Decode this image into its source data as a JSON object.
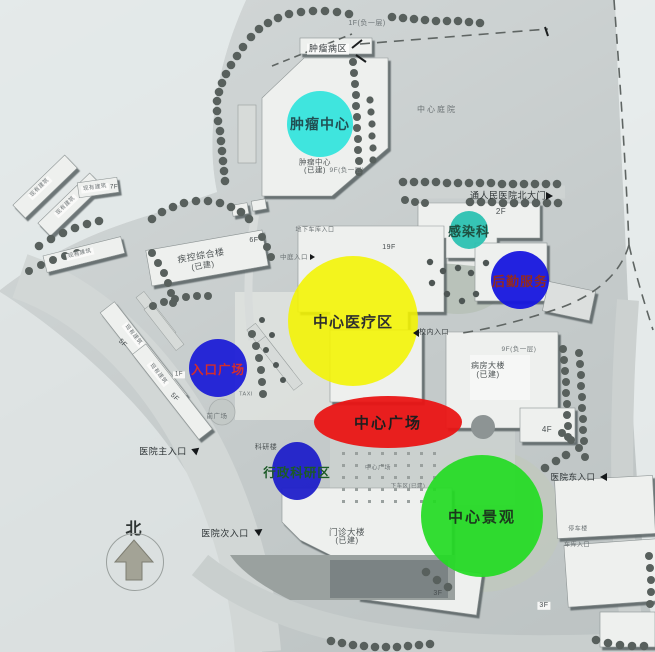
{
  "zones": [
    {
      "id": "tumor-center",
      "label": "肿瘤中心",
      "color": "#2ce4dc",
      "text_color": "#0b3d42"
    },
    {
      "id": "infection-dept",
      "label": "感染科",
      "color": "#26c0b0",
      "text_color": "#0d4433"
    },
    {
      "id": "logistics-service",
      "label": "后勤服务",
      "color": "#1717df",
      "text_color": "#8e1f14"
    },
    {
      "id": "central-medical",
      "label": "中心医疗区",
      "color": "#f4f400",
      "text_color": "#141414"
    },
    {
      "id": "entrance-plaza",
      "label": "入口广场",
      "color": "#1e1ed6",
      "text_color": "#d42424"
    },
    {
      "id": "central-plaza",
      "label": "中心广场",
      "color": "#ea1414",
      "text_color": "#141414"
    },
    {
      "id": "admin-research",
      "label": "行政科研区",
      "color": "#1f1fca",
      "text_color": "#14541f"
    },
    {
      "id": "central-landscape",
      "label": "中心景观",
      "color": "#23dc23",
      "text_color": "#0f2d10"
    }
  ],
  "labels": {
    "f1_neg1": "1F(负一层)",
    "tumor_ward": "肿瘤病区",
    "central_courtyard": "中心庭院",
    "north_gate": "通人民医院北大门",
    "f2": "2F",
    "tumor_built_name": "肿瘤中心",
    "tumor_built_sub": "(已建)",
    "f9_neg1_a": "9F(负一层)",
    "cdc_name": "疾控综合楼",
    "cdc_sub": "(已建)",
    "f6": "6F",
    "f19": "19F",
    "atrium_entrance": "中庭入口",
    "basement_entrance": "地下车库入口",
    "campus_entrance": "校内入口",
    "ward_name": "病房大楼",
    "ward_sub": "(已建)",
    "f9_neg1_b": "9F(负一层)",
    "f4": "4F",
    "plaza_paving": "中心广场",
    "dropoff": "下车区(已建)",
    "outpatient_name": "门诊大楼",
    "outpatient_sub": "(已建)",
    "f3_a": "3F",
    "f3_b": "3F",
    "east_entrance": "医院东入口",
    "main_entrance": "医院主入口",
    "second_entrance": "医院次入口",
    "front_plaza": "前广场",
    "taxi": "TAXI",
    "f5_a": "5F",
    "f5_b": "5F",
    "f1_small": "1F",
    "f7": "7F",
    "existing_building": "现有建筑",
    "research_building": "科研楼",
    "parking_a": "停车楼",
    "parking_b": "车库入口",
    "north": "北"
  }
}
